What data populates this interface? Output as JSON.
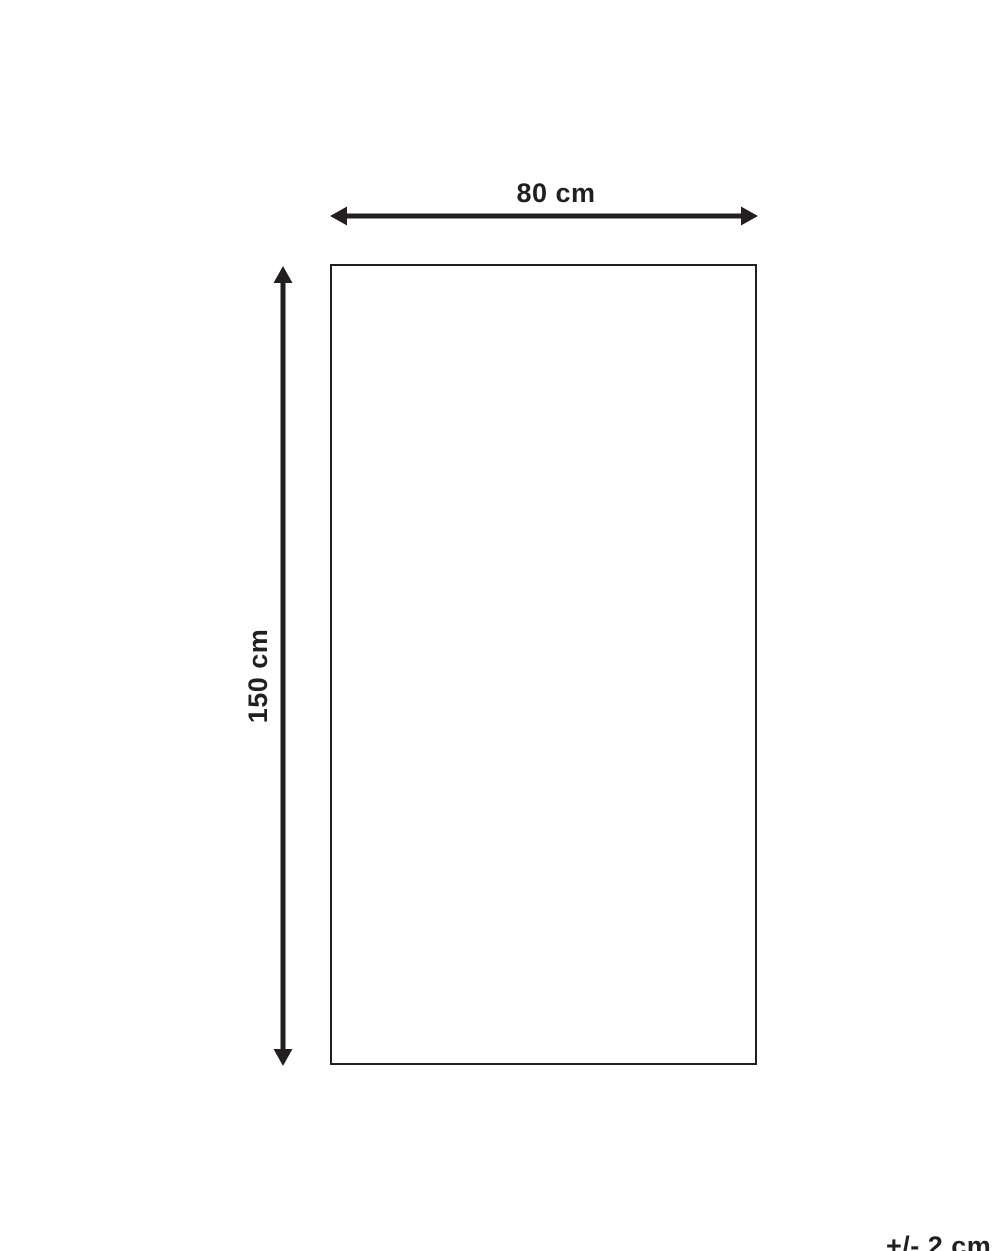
{
  "diagram": {
    "width_label": "80 cm",
    "height_label": "150 cm",
    "tolerance_label": "+/- 2 cm"
  },
  "colors": {
    "line": "#231f20",
    "background": "#ffffff"
  }
}
